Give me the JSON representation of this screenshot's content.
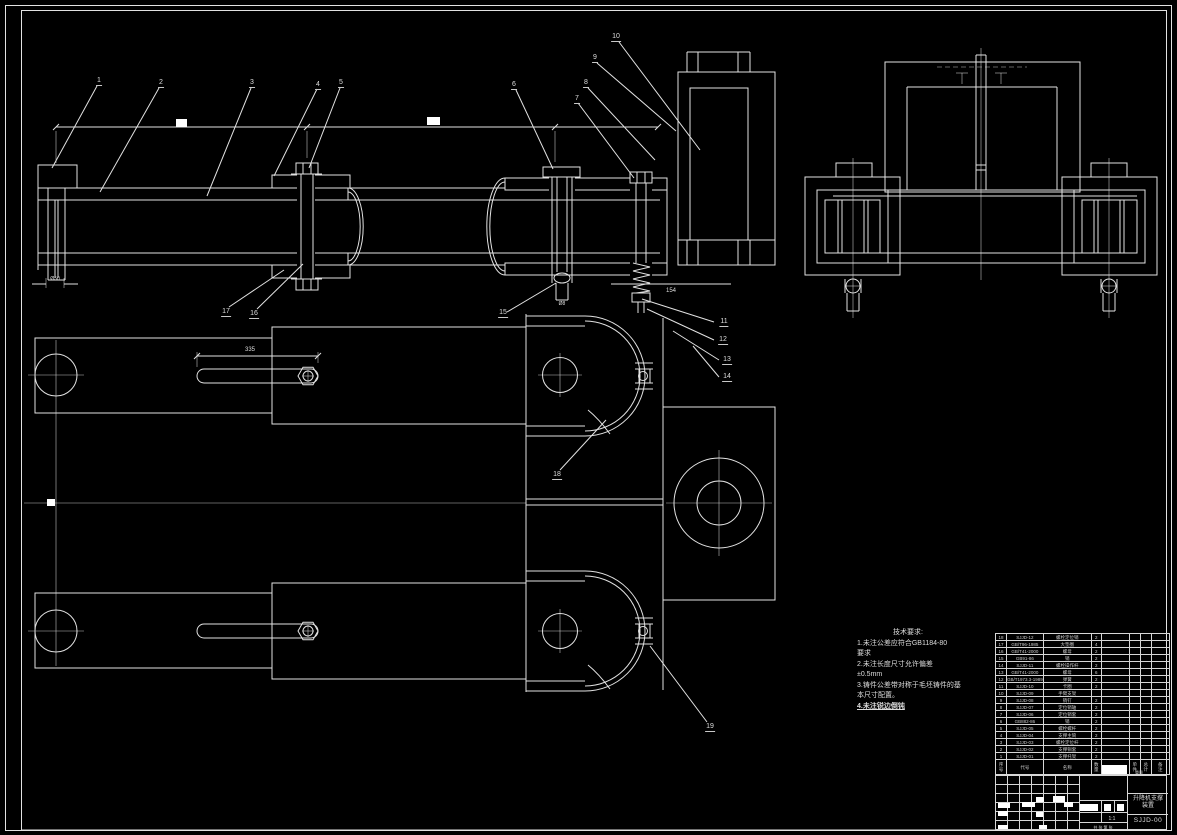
{
  "drawing": {
    "title_block": {
      "title_line1": "升降机支撑",
      "title_line2": "装置",
      "drawing_no": "SJJD-00",
      "scale": "1:1",
      "sheet_info": "共 张 第 张"
    },
    "tech_requirements": {
      "title": "技术要求:",
      "lines": [
        "1.未注公差应符合GB1184-80",
        "要求",
        "2.未注长度尺寸允许偏差",
        "±0.5mm",
        "3.铸件公差带对称于毛坯铸件的基",
        "本尺寸配置。",
        "4.未注锐边倒钝"
      ]
    },
    "bom": {
      "headers": {
        "seq": "序号",
        "code": "代号",
        "name": "名称",
        "qty": "数量",
        "material": "材料",
        "unit": "单件",
        "total": "总计",
        "weight": "重量",
        "remark": "备注"
      },
      "rows": [
        [
          "18",
          "SJJD-12",
          "螺栓定位销",
          "2"
        ],
        [
          "17",
          "GB/T96-1985",
          "大垫圈",
          "4"
        ],
        [
          "16",
          "GB/T41-2000",
          "螺母",
          "2"
        ],
        [
          "15",
          "GB91-86",
          "销",
          "2"
        ],
        [
          "14",
          "SJJD-11",
          "螺栓操作杆",
          "2"
        ],
        [
          "13",
          "GB/T41-2000",
          "螺母",
          "6"
        ],
        [
          "12",
          "GB/T1973.3-1989",
          "弹簧",
          "2"
        ],
        [
          "11",
          "SJJD-10",
          "卡圈",
          "2"
        ],
        [
          "10",
          "SJJD-09",
          "手臂支架",
          ""
        ],
        [
          "9",
          "SJJD-08",
          "销钉",
          "2"
        ],
        [
          "8",
          "SJJD-07",
          "定位销轴",
          "2"
        ],
        [
          "7",
          "SJJD-06",
          "定位销套",
          "2"
        ],
        [
          "6",
          "GB882-86",
          "销",
          "2"
        ],
        [
          "5",
          "SJJD-05",
          "螺栓螺杆",
          "2"
        ],
        [
          "4",
          "SJJD-04",
          "支撑主筒",
          "2"
        ],
        [
          "3",
          "SJJD-03",
          "螺栓定位杆",
          "2"
        ],
        [
          "2",
          "SJJD-02",
          "支撑铜套",
          "2"
        ],
        [
          "1",
          "SJJD-01",
          "支撑托架",
          "2"
        ]
      ]
    },
    "callouts": [
      {
        "label": "1",
        "x": 99,
        "y": 77
      },
      {
        "label": "2",
        "x": 161,
        "y": 79
      },
      {
        "label": "3",
        "x": 252,
        "y": 79
      },
      {
        "label": "4",
        "x": 318,
        "y": 81
      },
      {
        "label": "5",
        "x": 341,
        "y": 79
      },
      {
        "label": "6",
        "x": 514,
        "y": 81
      },
      {
        "label": "7",
        "x": 577,
        "y": 95
      },
      {
        "label": "8",
        "x": 586,
        "y": 79
      },
      {
        "label": "9",
        "x": 595,
        "y": 54
      },
      {
        "label": "10",
        "x": 616,
        "y": 33
      },
      {
        "label": "11",
        "x": 724,
        "y": 318
      },
      {
        "label": "12",
        "x": 723,
        "y": 336
      },
      {
        "label": "13",
        "x": 727,
        "y": 356
      },
      {
        "label": "14",
        "x": 727,
        "y": 373
      },
      {
        "label": "15",
        "x": 503,
        "y": 309
      },
      {
        "label": "16",
        "x": 254,
        "y": 310
      },
      {
        "label": "17",
        "x": 226,
        "y": 308
      },
      {
        "label": "18",
        "x": 557,
        "y": 471
      },
      {
        "label": "19",
        "x": 710,
        "y": 723
      }
    ],
    "dimensions": [
      {
        "text": "335",
        "x": 250,
        "y": 347,
        "size": "normal"
      },
      {
        "text": "154",
        "x": 671,
        "y": 288,
        "size": "normal"
      },
      {
        "text": "Ø50",
        "x": 55,
        "y": 276,
        "size": "small"
      },
      {
        "text": "Ø8",
        "x": 562,
        "y": 301,
        "size": "small"
      }
    ]
  }
}
